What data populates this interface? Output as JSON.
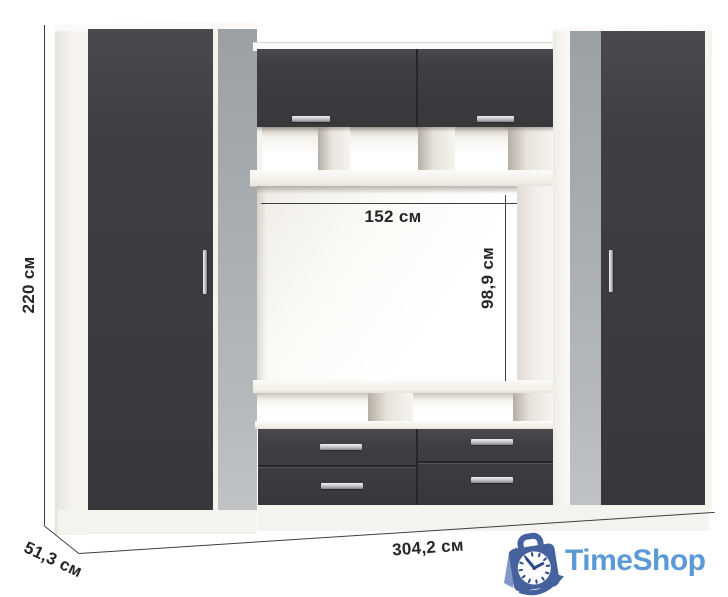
{
  "annotations": {
    "height_label": "220 см",
    "niche_width_label": "152 см",
    "niche_height_label": "98,9 см",
    "total_width_label": "304,2 см",
    "depth_label": "51,3 см"
  },
  "watermark": {
    "brand": "TimeShop",
    "icon": "clock-shopping-bag-icon"
  },
  "palette": {
    "background": "#ffffff",
    "front_dark": "#3d3d41",
    "mirror_gray": "#aab0b4",
    "carcass_white": "#f5f3ee",
    "handle_silver": "#bfc0c4",
    "dimension_line": "#3f3f3f",
    "label_text": "#262626",
    "logo_bag_blue": "#45629e",
    "logo_text_blue": "#5b9ad6",
    "logo_clock_marks": "#2d4a88"
  }
}
